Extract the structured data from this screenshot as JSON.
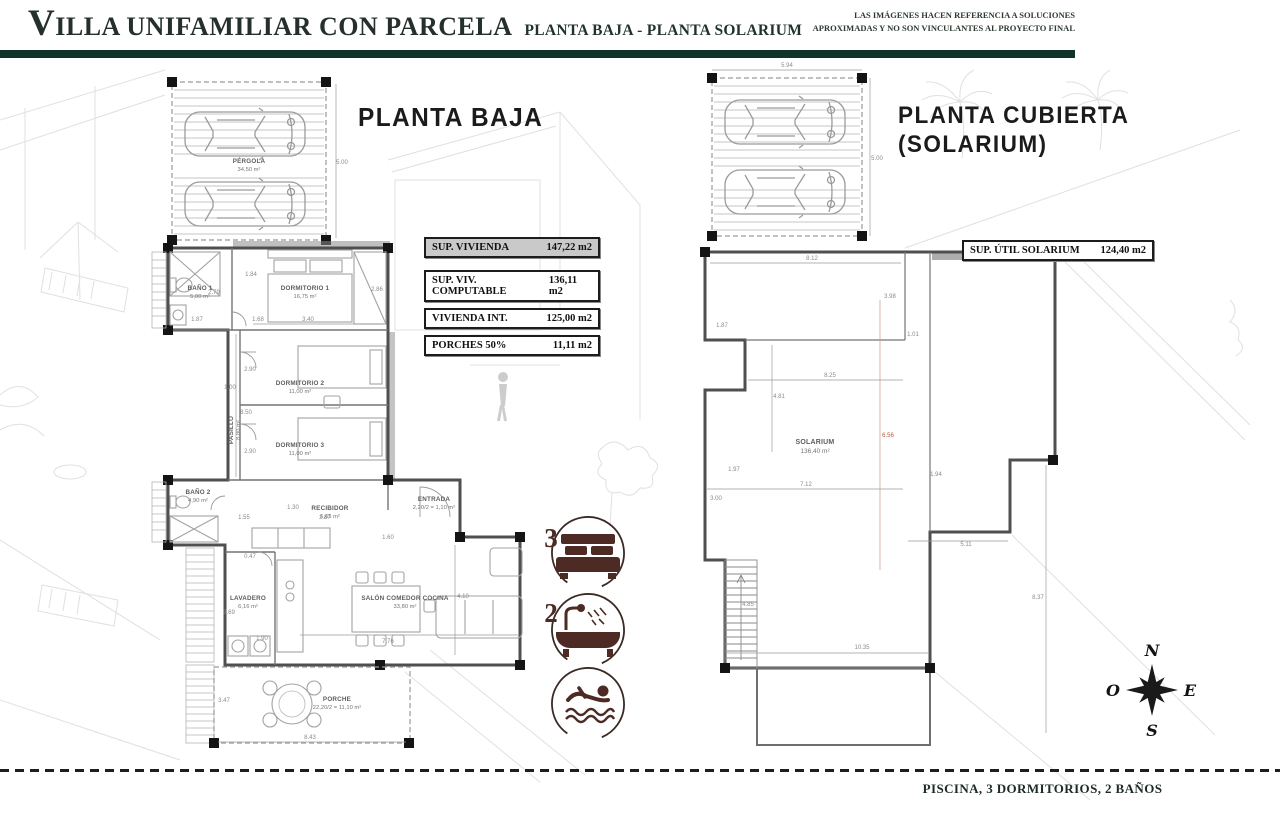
{
  "header": {
    "title_initial": "V",
    "title_rest": "ILLA UNIFAMILIAR CON PARCELA",
    "subtitle": "PLANTA BAJA - PLANTA SOLARIUM",
    "disclaimer_line1": "LAS IMÁGENES HACEN REFERENCIA A SOLUCIONES",
    "disclaimer_line2": "APROXIMADAS Y NO SON VINCULANTES AL PROYECTO FINAL"
  },
  "ground_floor": {
    "title": "PLANTA BAJA",
    "areas_table": {
      "rows": [
        {
          "label": "SUP. VIVIENDA",
          "value": "147,22 m2"
        },
        {
          "label": "SUP. VIV. COMPUTABLE",
          "value": "136,11 m2"
        },
        {
          "label": "VIVIENDA INT.",
          "value": "125,00 m2"
        },
        {
          "label": "PORCHES 50%",
          "value": "11,11 m2"
        }
      ]
    },
    "rooms": {
      "pergola": {
        "name": "PÉRGOLA",
        "area": "34,50 m²"
      },
      "bano1": {
        "name": "BAÑO 1",
        "area": "5,00 m²"
      },
      "dormitorio1": {
        "name": "DORMITORIO 1",
        "area": "16,75 m²"
      },
      "dormitorio2": {
        "name": "DORMITORIO 2",
        "area": "11,00 m²"
      },
      "dormitorio3": {
        "name": "DORMITORIO 3",
        "area": "11,00 m²"
      },
      "pasillo": {
        "name": "PASILLO",
        "area": "8,80 m²"
      },
      "bano2": {
        "name": "BAÑO 2",
        "area": "4,90 m²"
      },
      "recibidor": {
        "name": "RECIBIDOR",
        "area": "6,65 m²"
      },
      "entrada": {
        "name": "ENTRADA",
        "area": "2,20/2 = 1,10 m²"
      },
      "lavadero": {
        "name": "LAVADERO",
        "area": "6,16 m²"
      },
      "salon": {
        "name": "SALÓN COMEDOR COCINA",
        "area": "33,80 m²"
      },
      "porche": {
        "name": "PORCHE",
        "area": "22,20/2 = 11,10 m²"
      }
    },
    "dims": [
      "5.00",
      "1.84",
      "2.79",
      "3.40",
      "2.86",
      "1.87",
      "1.68",
      "2.90",
      "1.00",
      "8.50",
      "2.90",
      "1.30",
      "2.87",
      "1.55",
      "1.60",
      "0.47",
      "2.69",
      "1.90",
      "7.76",
      "4.10",
      "3.47",
      "8.43"
    ]
  },
  "solarium_floor": {
    "title_line1": "PLANTA CUBIERTA",
    "title_line2": "(SOLARIUM)",
    "areas_table": {
      "label": "SUP. ÚTIL SOLARIUM",
      "value": "124,40 m2"
    },
    "room": {
      "name": "SOLARIUM",
      "area": "136,40 m²"
    },
    "dims": [
      "5.94",
      "5.00",
      "8.12",
      "3.98",
      "1.87",
      "1.01",
      "8.25",
      "4.81",
      "6.56",
      "1.97",
      "7.12",
      "3.00",
      "1.94",
      "5.11",
      "4.85",
      "8.37",
      "10.35"
    ]
  },
  "features": {
    "bedrooms_count": "3",
    "bathrooms_count": "2"
  },
  "compass": {
    "north": "N",
    "east": "E",
    "south": "S",
    "west": "O"
  },
  "footer": {
    "caption": "PISCINA, 3 DORMITORIOS, 2 BAÑOS"
  },
  "colors": {
    "accent_green": "#0e332a",
    "icon_maroon": "#4d2a23",
    "dim_red": "#b0583f"
  }
}
